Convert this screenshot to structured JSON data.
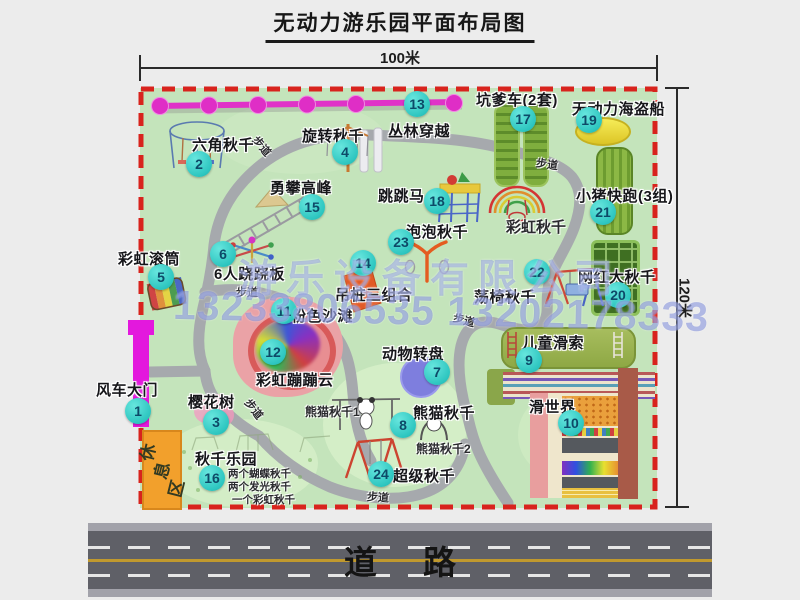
{
  "title": "无动力游乐园平面布局图",
  "dims": {
    "top": "100米",
    "right": "120米"
  },
  "road": {
    "label": "道路"
  },
  "watermark": {
    "company": "游乐设备有限公司",
    "phone": "13233806535 13202178333"
  },
  "rest_area": {
    "label": "休息区"
  },
  "colors": {
    "park_green": "#c4e4bb",
    "boundary_red": "#d8231d",
    "path_gray": "#a6a9ad",
    "badge_cyan": "#2ec6c0",
    "gate_magenta": "#e318dd",
    "rest_orange": "#f2a02c",
    "jungle_magenta": "#e032c8",
    "road_gray": "#5f6067"
  },
  "items": [
    {
      "num": "1",
      "label": "风车大门",
      "cx": 138,
      "cy": 411,
      "lx": 96,
      "ly": 379
    },
    {
      "num": "2",
      "label": "六角秋千",
      "cx": 199,
      "cy": 164,
      "lx": 192,
      "ly": 134
    },
    {
      "num": "3",
      "label": "樱花树",
      "cx": 216,
      "cy": 422,
      "lx": 188,
      "ly": 391
    },
    {
      "num": "4",
      "label": "旋转秋千",
      "cx": 345,
      "cy": 152,
      "lx": 302,
      "ly": 125
    },
    {
      "num": "5",
      "label": "彩虹滚筒",
      "cx": 161,
      "cy": 277,
      "lx": 118,
      "ly": 248
    },
    {
      "num": "6",
      "label": "6人跷跷板",
      "cx": 223,
      "cy": 254,
      "lx": 214,
      "ly": 263
    },
    {
      "num": "7",
      "label": "动物转盘",
      "cx": 437,
      "cy": 372,
      "lx": 382,
      "ly": 343
    },
    {
      "num": "8",
      "label": "熊猫秋千",
      "cx": 403,
      "cy": 425,
      "lx": 413,
      "ly": 402
    },
    {
      "num": "9",
      "label": "儿童滑索",
      "cx": 529,
      "cy": 360,
      "lx": 522,
      "ly": 332
    },
    {
      "num": "10",
      "label": "滑世界",
      "cx": 571,
      "cy": 423,
      "lx": 529,
      "ly": 396
    },
    {
      "num": "11",
      "label": "粉色沙滩",
      "cx": 284,
      "cy": 311,
      "lx": 291,
      "ly": 305
    },
    {
      "num": "12",
      "label": "彩虹蹦蹦云",
      "cx": 273,
      "cy": 352,
      "lx": 256,
      "ly": 369
    },
    {
      "num": "13",
      "label": "丛林穿越",
      "cx": 417,
      "cy": 104,
      "lx": 388,
      "ly": 120
    },
    {
      "num": "14",
      "label": "吊桩三组合",
      "cx": 363,
      "cy": 263,
      "lx": 335,
      "ly": 284
    },
    {
      "num": "15",
      "label": "勇攀高峰",
      "cx": 312,
      "cy": 207,
      "lx": 270,
      "ly": 177
    },
    {
      "num": "16",
      "label": "秋千乐园",
      "cx": 212,
      "cy": 478,
      "lx": 195,
      "ly": 448
    },
    {
      "num": "17",
      "label": "坑爹车(2套)",
      "cx": 523,
      "cy": 119,
      "lx": 476,
      "ly": 89
    },
    {
      "num": "18",
      "label": "跳跳马",
      "cx": 437,
      "cy": 201,
      "lx": 378,
      "ly": 185
    },
    {
      "num": "19",
      "label": "无动力海盗船",
      "cx": 589,
      "cy": 120,
      "lx": 572,
      "ly": 98
    },
    {
      "num": "20",
      "label": "网红大秋千",
      "cx": 618,
      "cy": 295,
      "lx": 578,
      "ly": 266
    },
    {
      "num": "21",
      "label": "小猪快跑(3组)",
      "cx": 603,
      "cy": 212,
      "lx": 576,
      "ly": 185
    },
    {
      "num": "22",
      "label": "荡椅秋千",
      "cx": 537,
      "cy": 272,
      "lx": 474,
      "ly": 286
    },
    {
      "num": "23",
      "label": "泡泡秋千",
      "cx": 401,
      "cy": 242,
      "lx": 406,
      "ly": 221
    },
    {
      "num": "24",
      "label": "超级秋千",
      "cx": 381,
      "cy": 474,
      "lx": 393,
      "ly": 465
    }
  ],
  "notes": [
    {
      "text": "彩虹秋千",
      "x": 506,
      "y": 216,
      "size": 15,
      "rot": 0
    },
    {
      "text": "熊猫秋千1",
      "x": 305,
      "y": 403,
      "size": 12,
      "rot": 0
    },
    {
      "text": "熊猫秋千2",
      "x": 416,
      "y": 440,
      "size": 12,
      "rot": 0
    },
    {
      "text": "两个蝴蝶秋千",
      "x": 228,
      "y": 466,
      "size": 10.5,
      "rot": 0
    },
    {
      "text": "两个发光秋千",
      "x": 228,
      "y": 479,
      "size": 10.5,
      "rot": 0
    },
    {
      "text": "一个彩虹秋千",
      "x": 232,
      "y": 492,
      "size": 10.5,
      "rot": 0
    },
    {
      "text": "步道",
      "x": 251,
      "y": 138,
      "size": 11,
      "rot": 50
    },
    {
      "text": "步道",
      "x": 536,
      "y": 156,
      "size": 11,
      "rot": 8
    },
    {
      "text": "步道",
      "x": 236,
      "y": 284,
      "size": 11,
      "rot": 0
    },
    {
      "text": "步道",
      "x": 453,
      "y": 312,
      "size": 11,
      "rot": 15
    },
    {
      "text": "步道",
      "x": 243,
      "y": 401,
      "size": 11,
      "rot": 52
    },
    {
      "text": "步道",
      "x": 367,
      "y": 489,
      "size": 11,
      "rot": 4
    }
  ]
}
